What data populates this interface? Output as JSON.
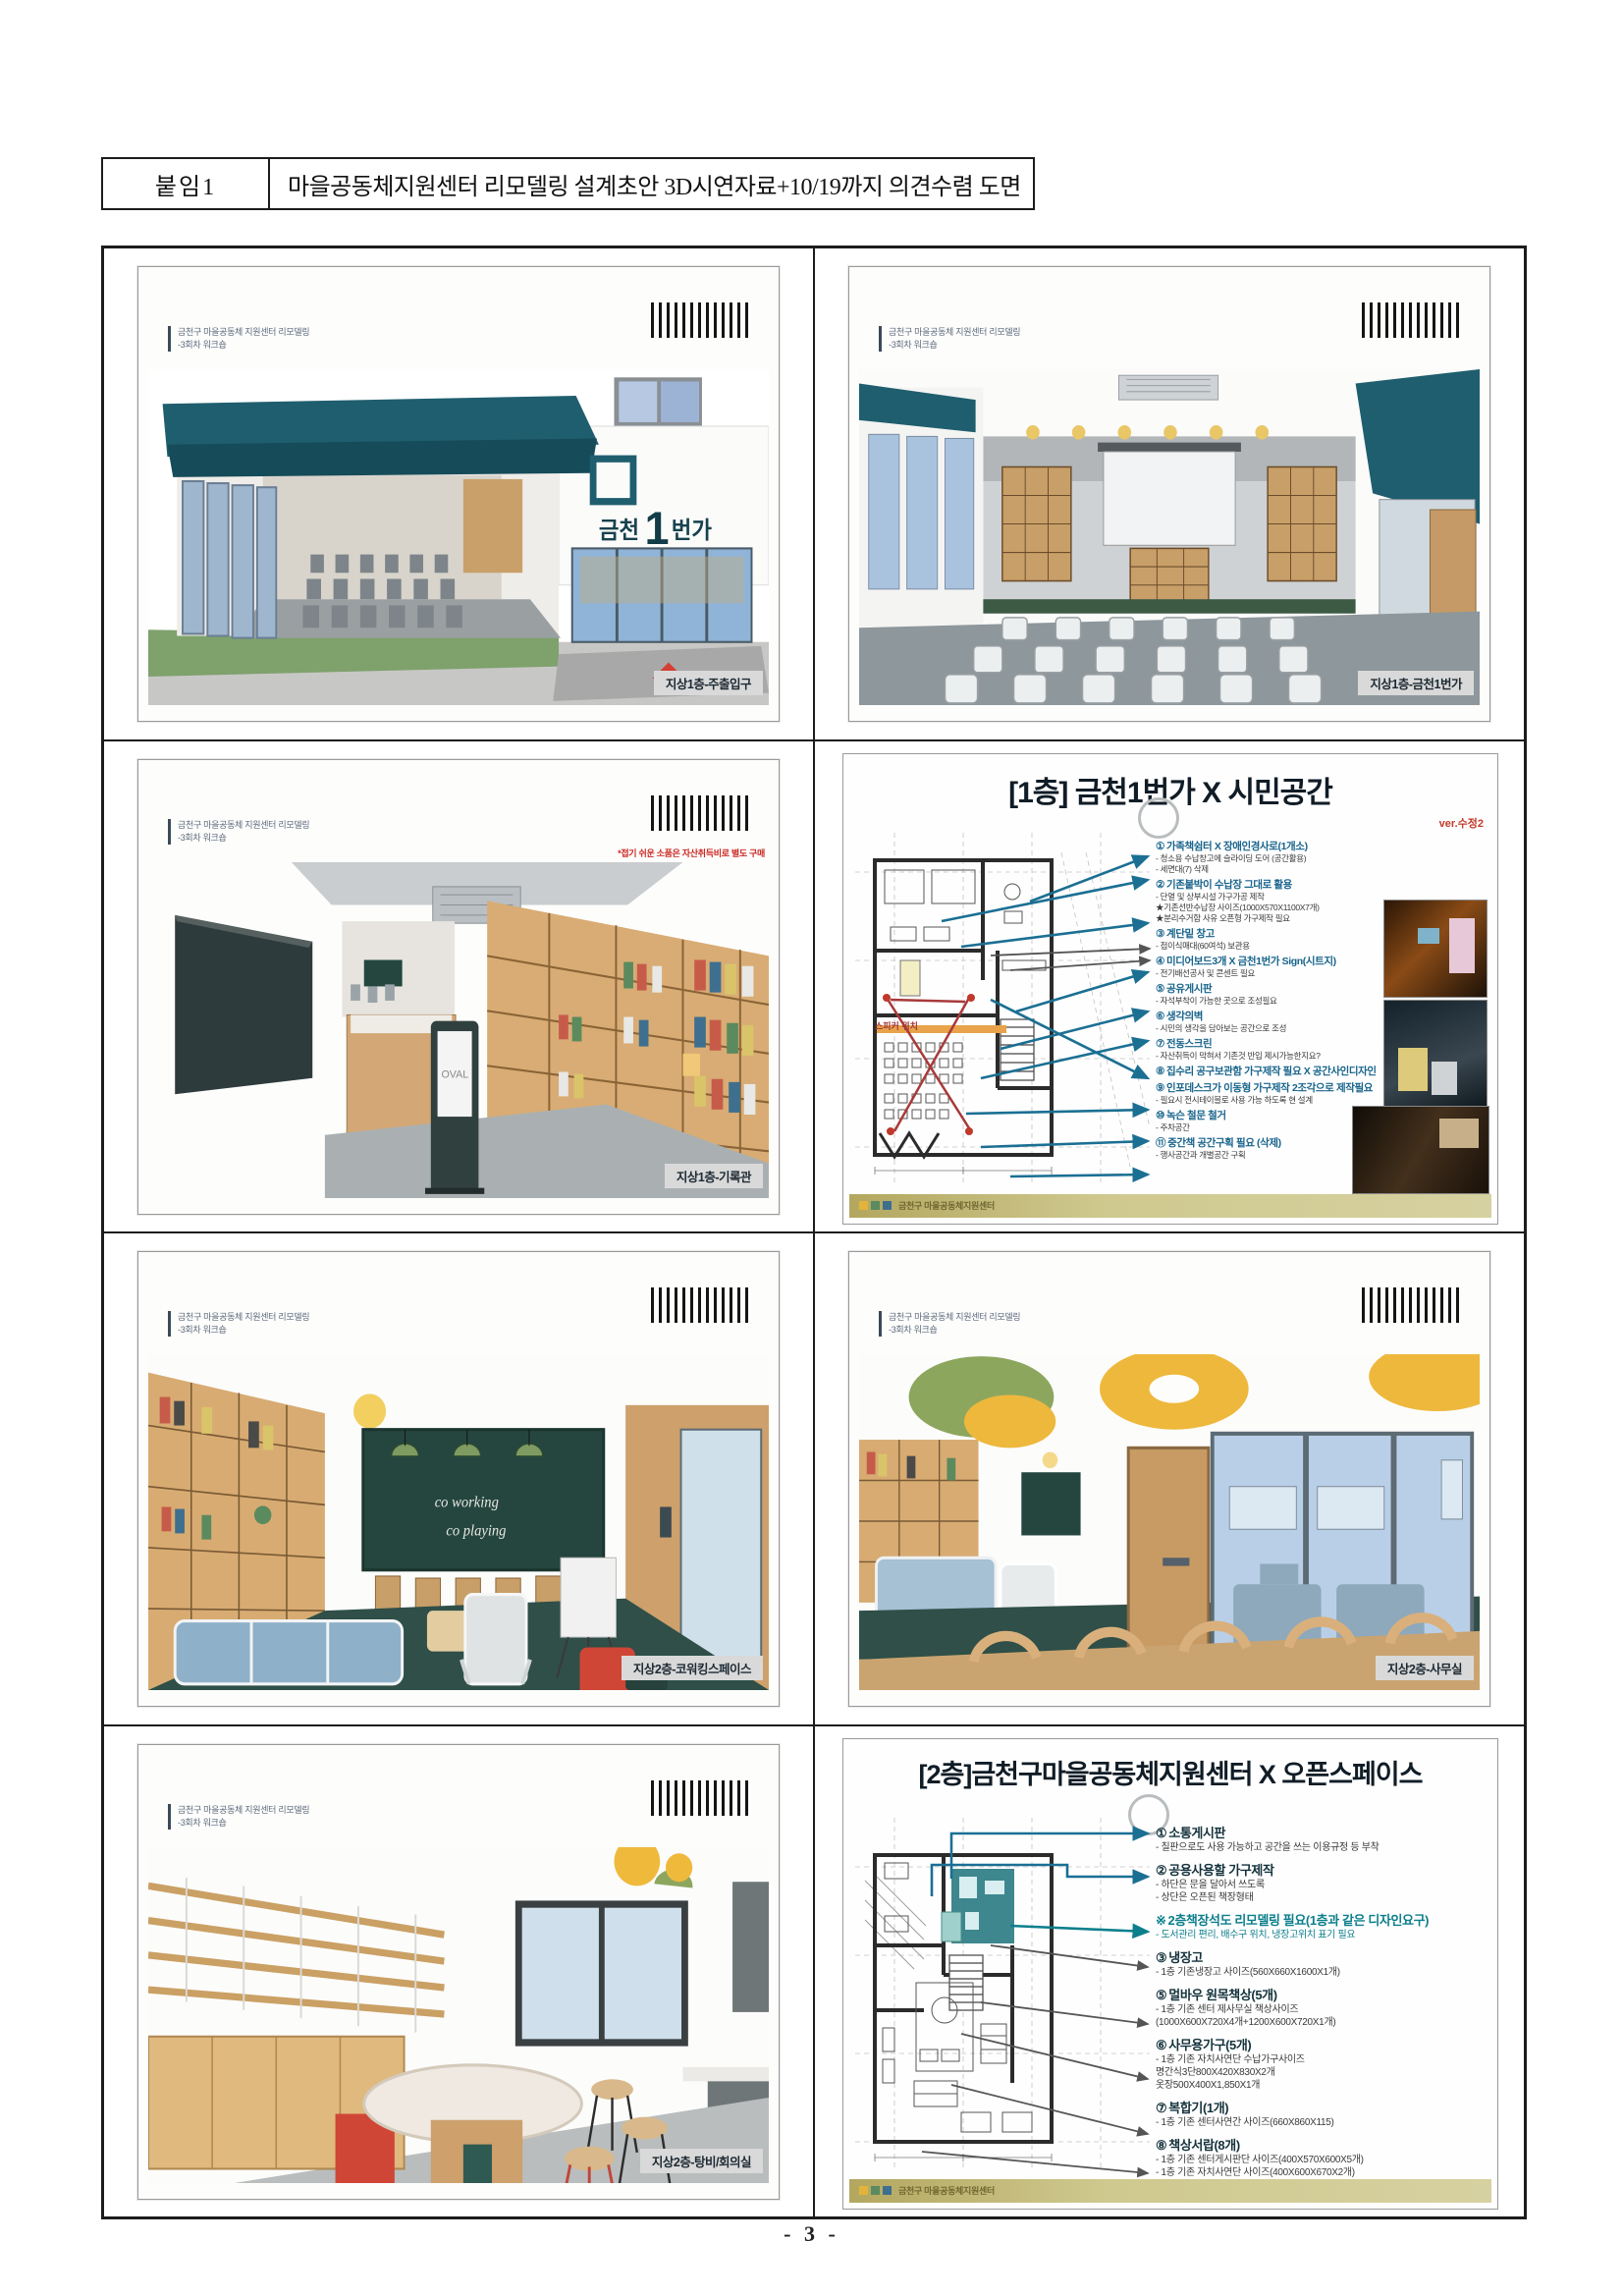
{
  "page": {
    "attachment_label": "붙임1",
    "title": "마을공동체지원센터 리모델링 설계초안 3D시연자료+10/19까지 의견수렴 도면",
    "page_number": "- 3 -"
  },
  "slide_common": {
    "header_line1": "금천구 마을공동체 지원센터 리모델링",
    "header_line2": "-3회차 워크숍"
  },
  "slides": {
    "entrance": {
      "caption": "지상1층-주출입구",
      "sign_prefix": "금천",
      "sign_big": "1",
      "sign_suffix": "번가"
    },
    "hall": {
      "caption": "지상1층-금천1번가"
    },
    "archive": {
      "caption": "지상1층-기록관",
      "note_red": "*접기 쉬운 소품은 자산취득비로 별도 구매",
      "kiosk_label": "OVAL"
    },
    "plan1f": {
      "title": "[1층] 금천1번가 X 시민공간",
      "version": "ver.수정2",
      "plan_label": "스피커 위치",
      "footer_logo": "금천구 마을공동체지원센터",
      "annotations": [
        {
          "num": "①",
          "title": "가족책쉼터 X 장애인경사로(1개소)",
          "lines": [
            "- 청소용 수납창고에 슬라이딩 도어 (공간활용)",
            "- 세면대(7) 삭제"
          ]
        },
        {
          "num": "②",
          "title": "기존붙박이 수납장 그대로 활용",
          "lines": [
            "- 단열 및 상부시설 가구가공 제작",
            "★기존선반수납장 사이즈(1000X570X1100X7개)",
            "★분리수거함 사유 오픈형 가구제작 필요"
          ]
        },
        {
          "num": "③",
          "title": "계단밑 창고",
          "lines": [
            "- 접이식매대(60여석) 보관용"
          ]
        },
        {
          "num": "④",
          "title": "미디어보드3개 X 금천1번가 Sign(시트지)",
          "lines": [
            "- 전기배선공사 및 콘센트 필요"
          ]
        },
        {
          "num": "⑤",
          "title": "공유게시판",
          "lines": [
            "- 자석부착이 가능한 곳으로 조성필요"
          ]
        },
        {
          "num": "⑥",
          "title": "생각의벽",
          "lines": [
            "- 시민의 생각을 담아보는 공간으로 조성"
          ]
        },
        {
          "num": "⑦",
          "title": "전동스크린",
          "lines": [
            "- 자산취득이 막혀서 기존것 반입 제시가능한지요?"
          ]
        },
        {
          "num": "⑧",
          "title": "집수리 공구보관함 가구제작 필요 X 공간사인디자인",
          "lines": []
        },
        {
          "num": "⑨",
          "title": "인포데스크가 이동형 가구제작 2조각으로 제작필요",
          "lines": [
            "- 필요시 전시테이블로 사용 가능 하도록 현 설계"
          ]
        },
        {
          "num": "⑩",
          "title": "녹슨 철문 철거",
          "lines": [
            "- 주차공간"
          ]
        },
        {
          "num": "⑪",
          "title": "중간책 공간구획 필요 (삭제)",
          "lines": [
            "- 행사공간과 개별공간 구획"
          ]
        }
      ]
    },
    "coworking": {
      "caption": "지상2층-코워킹스페이스",
      "board_line1": "co working",
      "board_line2": "co playing"
    },
    "office": {
      "caption": "지상2층-사무실"
    },
    "pantry": {
      "caption": "지상2층-탕비/회의실"
    },
    "plan2f": {
      "title": "[2층]금천구마을공동체지원센터 X 오픈스페이스",
      "footer_logo": "금천구 마을공동체지원센터",
      "annotations": [
        {
          "num": "①",
          "title": "소통게시판",
          "lines": [
            "- 칠판으로도 사용 가능하고 공간을 쓰는 이용규정 등 부착"
          ]
        },
        {
          "num": "②",
          "title": "공용사용할 가구제작",
          "lines": [
            "- 하단은 문을 달아서 쓰도록",
            "- 상단은 오픈된 책장형태"
          ]
        },
        {
          "num": "※",
          "title": "2층책장석도 리모델링 필요(1층과 같은 디자인요구)",
          "variant": "note",
          "lines": [
            "- 도서관리 편리, 배수구 위치, 냉장고위치 표기 필요"
          ]
        },
        {
          "num": "③",
          "title": "냉장고",
          "lines": [
            "- 1층 기존냉장고 사이즈(560X660X1600X1개)"
          ]
        },
        {
          "num": "⑤",
          "title": "멀바우 원목책상(5개)",
          "lines": [
            "- 1층 기존 센터 제사무실 책상사이즈",
            "(1000X600X720X4개+1200X600X720X1개)"
          ]
        },
        {
          "num": "⑥",
          "title": "사무용가구(5개)",
          "lines": [
            "- 1층 기존 자치사연단 수납가구사이즈",
            "명간식3단800X420X830X2개",
            "옷장500X400X1,850X1개"
          ]
        },
        {
          "num": "⑦",
          "title": "복합기(1개)",
          "lines": [
            "- 1층 기존 센터사연간 사이즈(660X860X115)"
          ]
        },
        {
          "num": "⑧",
          "title": "책상서랍(8개)",
          "lines": [
            "- 1층 기존 센터게시판단 사이즈(400X570X600X5개)",
            "- 1층 기존 자치사연단 사이즈(400X600X670X2개)",
            "- 1층 기존 서랍장 사이즈(400X570X600X3개X1개)"
          ]
        }
      ]
    }
  }
}
